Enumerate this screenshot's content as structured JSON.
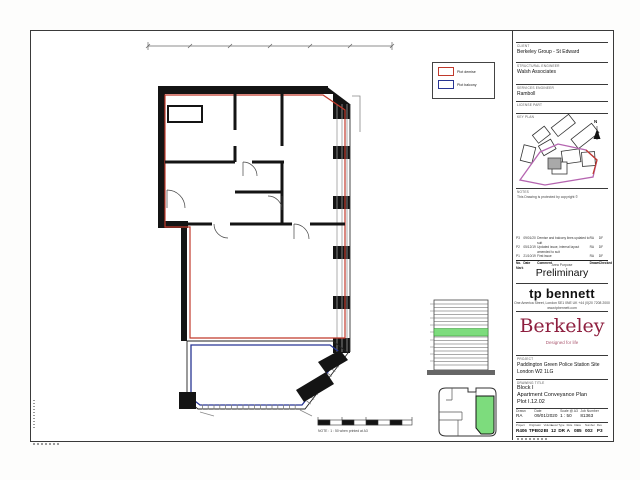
{
  "colors": {
    "demise": "#c0392b",
    "balcony": "#283593",
    "highlight": "#7ddc7d",
    "brand": "#8e1f3f"
  },
  "legend": {
    "demise_label": "Plot demise",
    "balcony_label": "Plot balcony"
  },
  "plan": {
    "scale_note": "NOTE : 1 : 50 when printed at A3"
  },
  "titleblock": {
    "client_label": "CLIENT",
    "client": "Berkeley Group - St Edward",
    "structural_label": "STRUCTURAL ENGINEER",
    "structural": "Walsh Associates",
    "services_label": "SERVICES ENGINEER",
    "services": "Ramboll",
    "license_label": "LICENSE PART",
    "keyplan_label": "KEY PLAN",
    "north": "N",
    "notes_label": "Notes",
    "copyright": "This Drawing is protected by copyright ©",
    "revisions": {
      "h_no": "No.",
      "h_mark": "Mark",
      "h_date": "Date",
      "h_comment": "Comment",
      "h_drawn": "Drawn",
      "h_chk": "Checked",
      "rows": [
        {
          "no": "P3",
          "date": "09/01/20",
          "comment": "Demise and balcony lines updated to suit",
          "drawn": "RA",
          "chk": "DF"
        },
        {
          "no": "P2",
          "date": "05/12/19",
          "comment": "Updated issue, internal layout amended to suit",
          "drawn": "RA",
          "chk": "DF"
        },
        {
          "no": "P1",
          "date": "21/10/19",
          "comment": "First issue",
          "drawn": "RA",
          "chk": "DF"
        }
      ]
    },
    "area_purpose_label": "Area Purpose",
    "status": "Preliminary",
    "firm": "tp bennett",
    "address": "One America Street, London  SE1 0NE  UK  +44 (0)20 7208 2000",
    "web": "www.tpbennett.com",
    "brand": "Berkeley",
    "tagline": "Designed for life",
    "project_label": "Project",
    "project1": "Paddington Green Police Station Site",
    "project2": "London W2 1LG",
    "title_label": "Drawing Title",
    "title1": "Block I",
    "title2": "Apartment Conveyance Plan",
    "title3": "Plot I.12.02",
    "meta": {
      "drawn_label": "Drawn",
      "drawn": "RA",
      "date_label": "Date",
      "date": "09/01/2020",
      "scale_label": "Scale @ A3",
      "scale": "1 : 50",
      "job_label": "Job Number",
      "job": "81363"
    },
    "doc": {
      "headers": [
        "Project",
        "Originator",
        "Volume",
        "Level",
        "Type",
        "Role",
        "Class",
        "Number",
        "Rev"
      ],
      "values": [
        "R406",
        "TPB02",
        "BI",
        "12",
        "DR",
        "A",
        "085",
        "002",
        "P3"
      ]
    }
  }
}
